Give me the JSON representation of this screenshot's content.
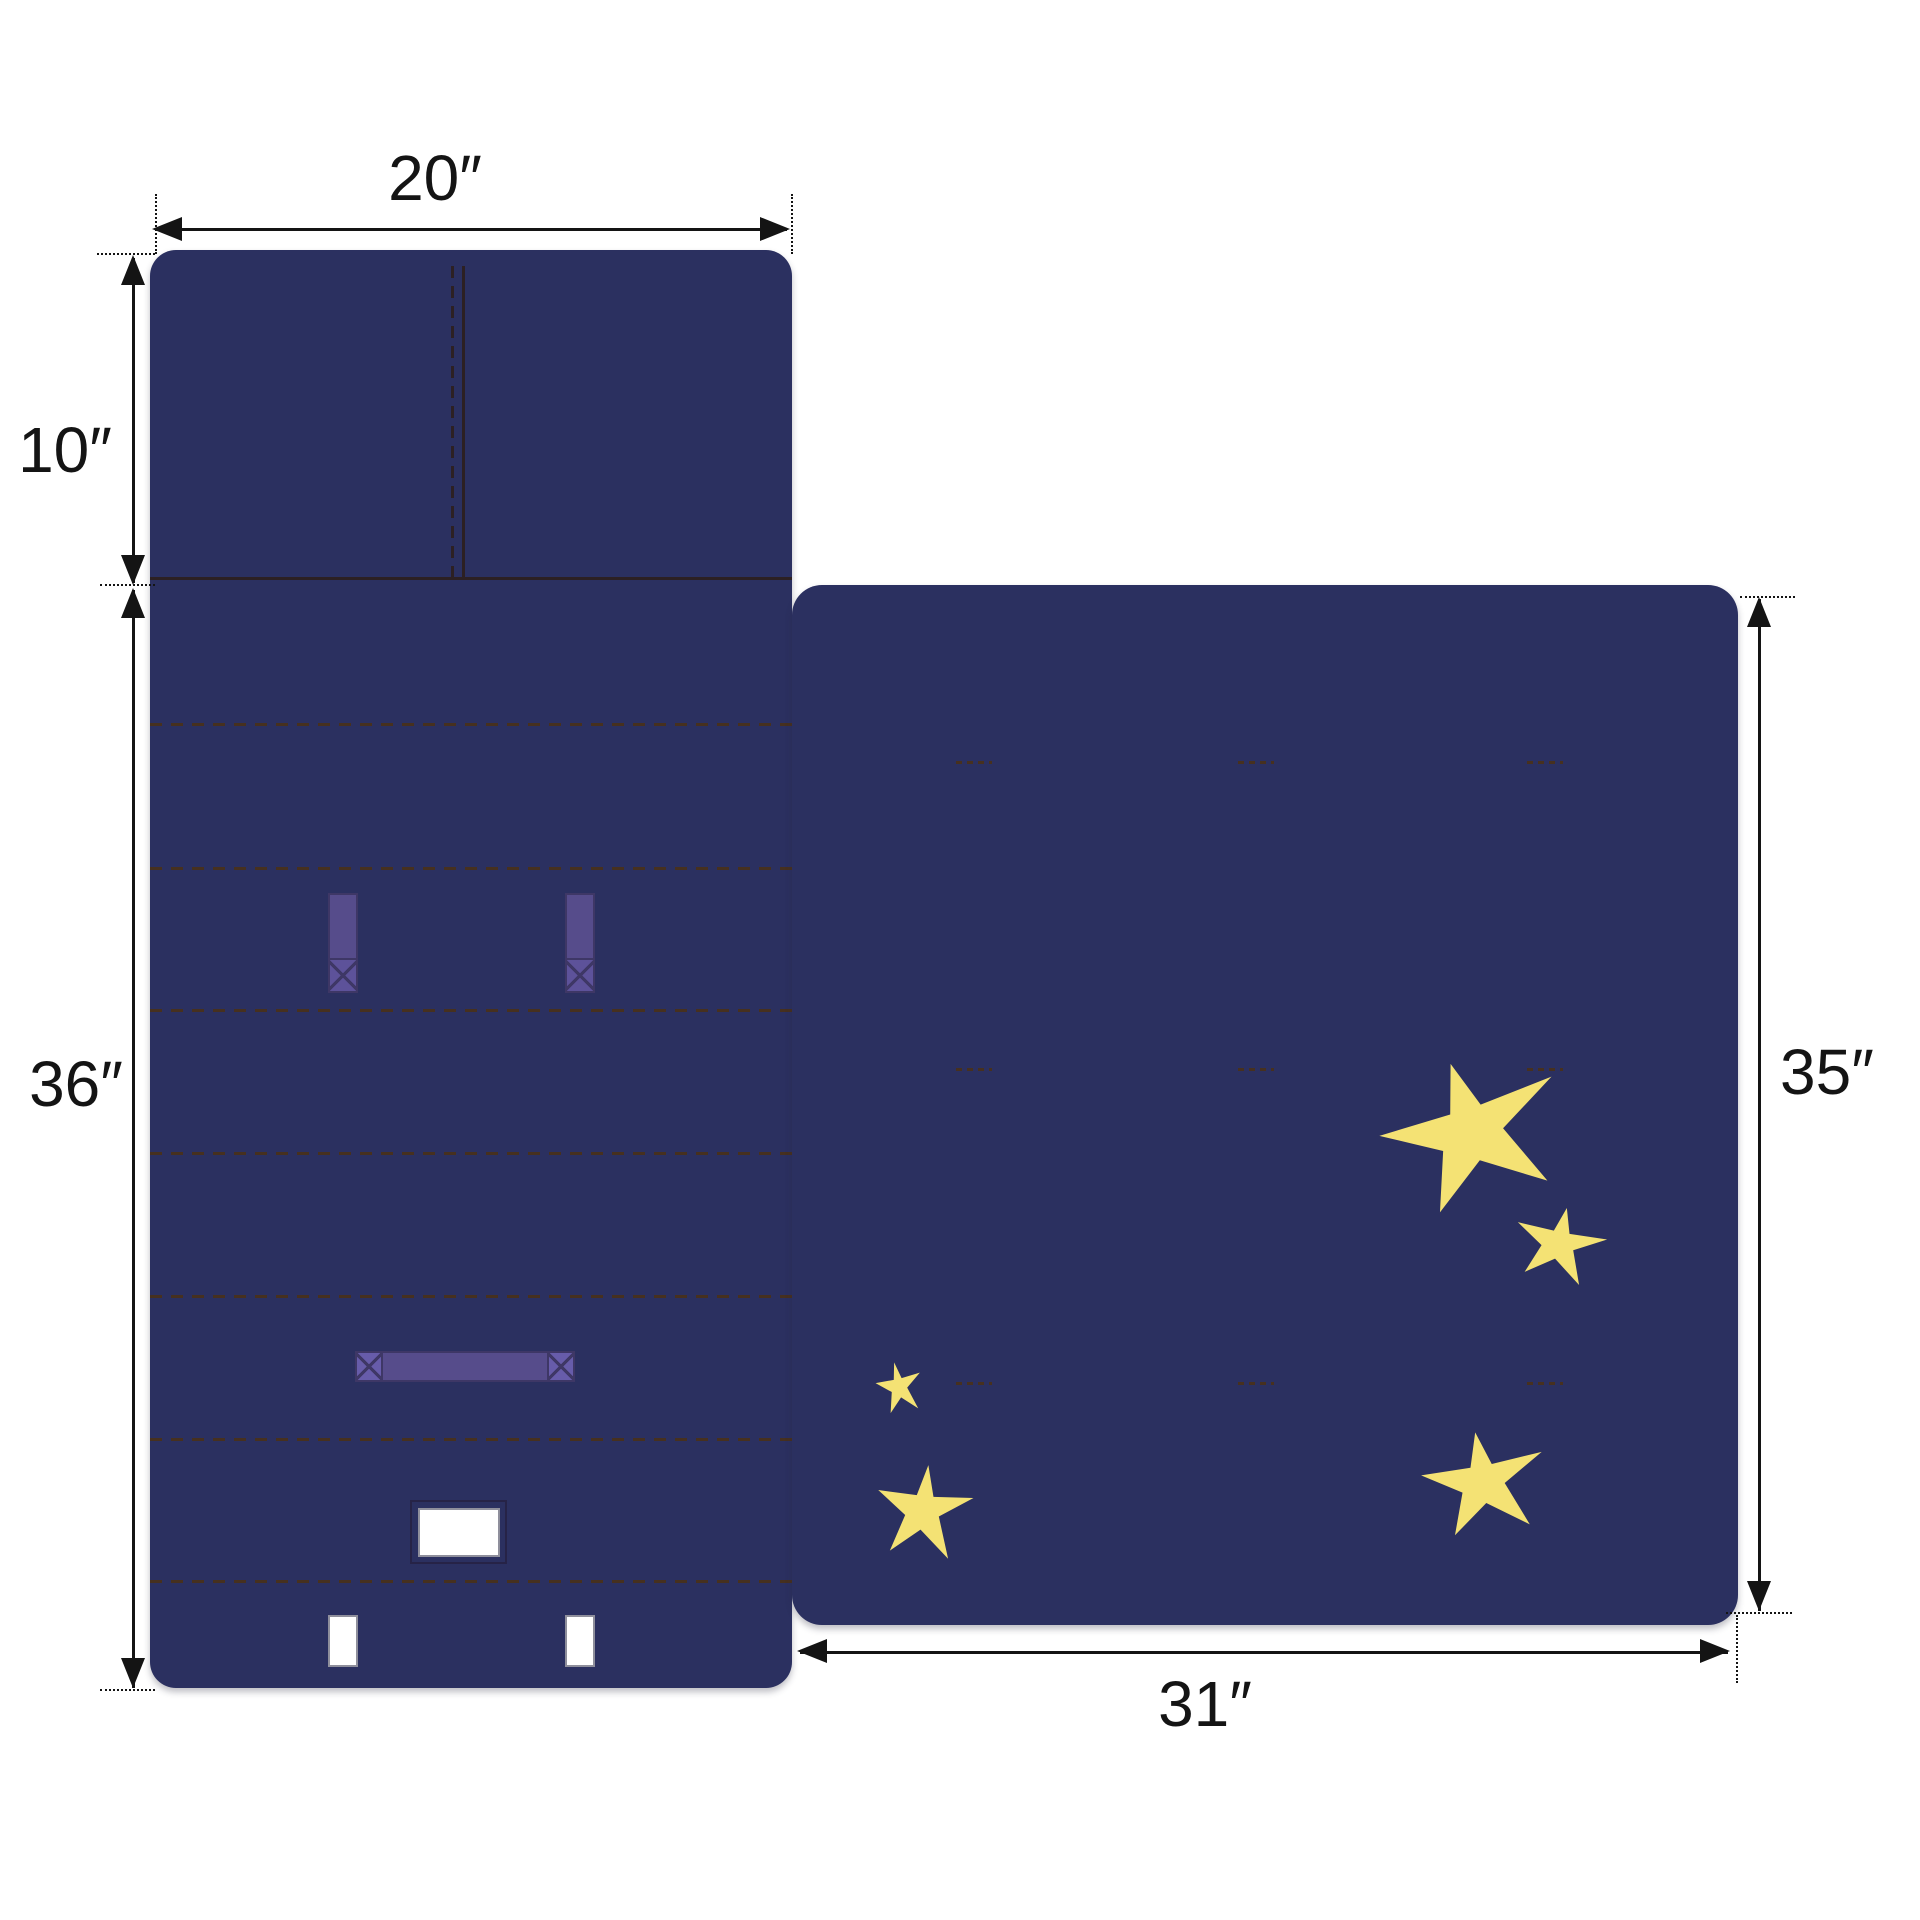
{
  "diagram": {
    "type": "product-dimension-diagram",
    "subject": "nap mat back panel with pillow section, straps and star-print blanket panel",
    "labels": {
      "mat_width": "20″",
      "pillow_height": "10″",
      "mat_body_height": "36″",
      "blanket_height": "35″",
      "blanket_width": "31″"
    }
  },
  "colors": {
    "background": "#ffffff",
    "panel-navy": "#2b3060",
    "stitch-brown": "#46301f",
    "seam-dark": "#2c2023",
    "strap-purple": "#564c8b",
    "strap-purple-box": "#5d529a",
    "strap-purple-light": "#675caa",
    "strap-border": "#3e3766",
    "star-yellow": "#f4e274",
    "cutout-white": "#ffffff",
    "cutout-border": "#8f8f9c",
    "dim-line": "#141414"
  }
}
